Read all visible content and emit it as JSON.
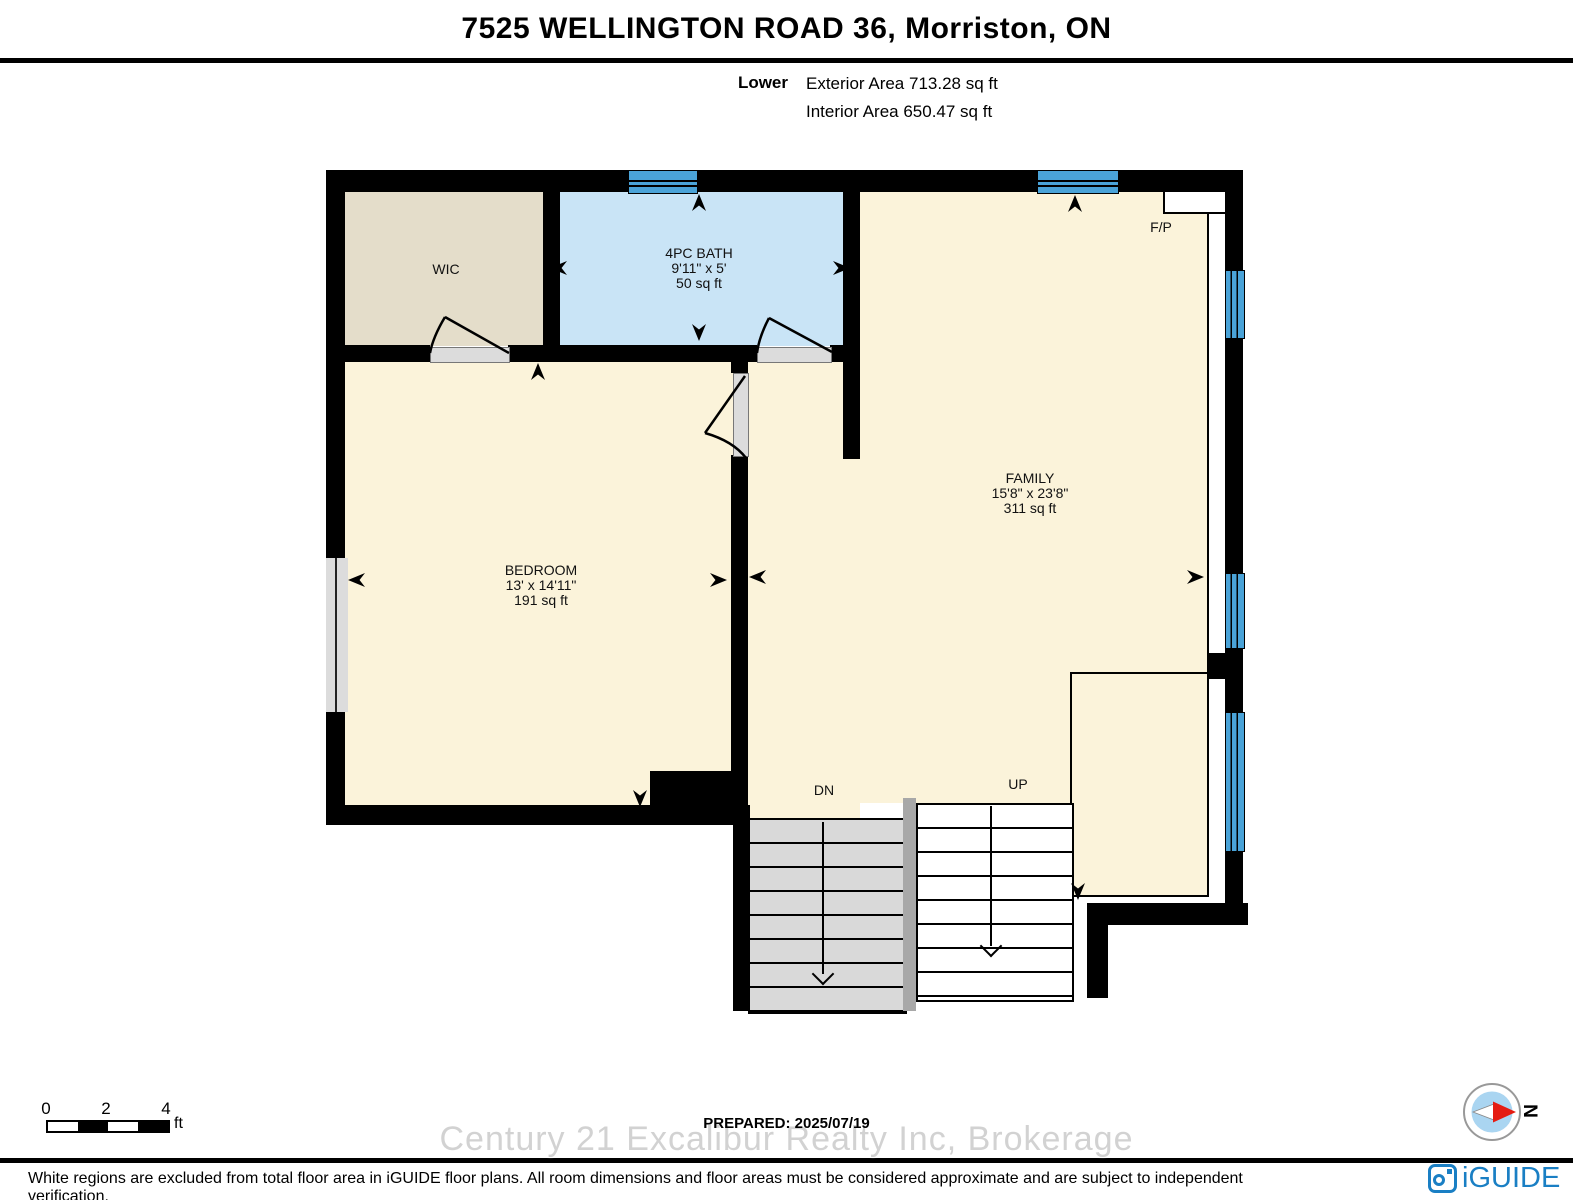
{
  "header": {
    "title": "7525 WELLINGTON ROAD 36, Morriston, ON",
    "floor_label": "Lower",
    "exterior_area": "Exterior Area 713.28 sq ft",
    "interior_area": "Interior Area 650.47 sq ft"
  },
  "rooms": {
    "wic": {
      "name": "WIC"
    },
    "bath": {
      "name": "4PC BATH",
      "dimensions": "9'11\" x 5'",
      "area": "50 sq ft"
    },
    "family": {
      "name": "FAMILY",
      "dimensions": "15'8\" x 23'8\"",
      "area": "311 sq ft"
    },
    "bedroom": {
      "name": "BEDROOM",
      "dimensions": "13' x 14'11\"",
      "area": "191 sq ft"
    }
  },
  "annotations": {
    "fireplace": "F/P",
    "stairs_down": "DN",
    "stairs_up": "UP"
  },
  "scale_bar": {
    "ticks": [
      "0",
      "2",
      "4"
    ],
    "unit": "ft"
  },
  "compass": {
    "north_label": "N"
  },
  "footer": {
    "prepared": "PREPARED: 2025/07/19",
    "watermark": "Century 21 Excalibur Realty Inc, Brokerage",
    "disclaimer": "White regions are excluded from total floor area in iGUIDE floor plans. All room dimensions and floor areas must be considered approximate and are subject to independent verification.",
    "brand": "iGUIDE"
  },
  "colors": {
    "wall_black": "#000000",
    "floor_cream": "#fbf3da",
    "floor_tan": "#e4ddca",
    "floor_bath_blue": "#c9e4f6",
    "window_blue": "#4aa3d8",
    "stair_gray": "#d9d9d9",
    "stair_divider_gray": "#a8a8a8",
    "door_gray": "#dcdcdc",
    "watermark_gray": "#d2d2d2",
    "brand_blue": "#1a7fc4",
    "compass_fill_blue": "#aad5f1",
    "compass_needle_red": "#e51c12"
  }
}
